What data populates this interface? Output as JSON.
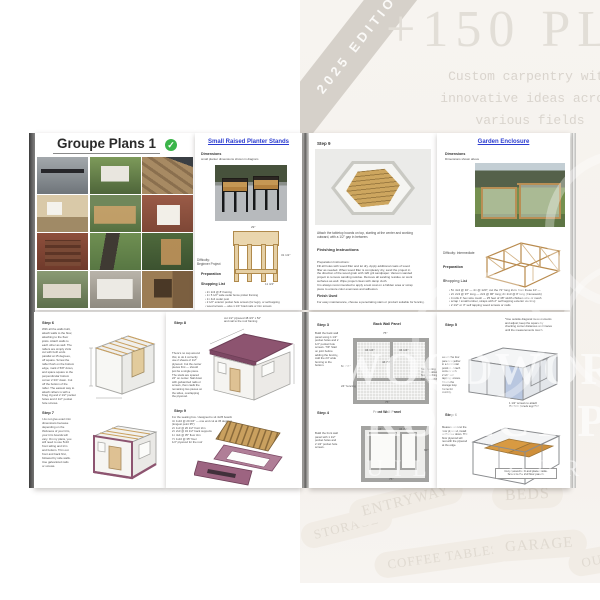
{
  "background": {
    "edition_ribbon": "2025 EDITION",
    "headline": "+150 PLANS",
    "tagline": [
      "Custom carpentry with",
      "innovative ideas across",
      "various fields"
    ],
    "watermark_line1": "WOODWORK",
    "watermark_line2": "PROJECT PLANS",
    "watermark_line3": "BUILD YOUR KINGDOM",
    "pills": [
      {
        "label": "STORAGE",
        "kind": "pill-storage"
      },
      {
        "label": "ENTRYWAY",
        "kind": "pill-entryway"
      },
      {
        "label": "BEDS",
        "kind": "pill-beds"
      },
      {
        "label": "COFFEE TABLES",
        "kind": "pill-coffee"
      },
      {
        "label": "GARAGE",
        "kind": "pill-garage"
      },
      {
        "label": "OUTDOOR",
        "kind": "pill-outdoor"
      }
    ],
    "colors": {
      "backdrop": "#f6f3ee",
      "ribbon": "#d6d1ca",
      "faint_text": "#ddd8d1"
    }
  },
  "colors": {
    "title_blue": "#2a3bd0",
    "check_green": "#3bb54a",
    "plum": "#8d5470",
    "floor_orange": "#d89a42"
  },
  "cover": {
    "title": "Groupe Plans 1",
    "check_icon": "✓",
    "photos": [
      {
        "kind": "ph-console"
      },
      {
        "kind": "ph-coop"
      },
      {
        "kind": "ph-deck"
      },
      {
        "kind": "ph-playhouse"
      },
      {
        "kind": "ph-enclosure"
      },
      {
        "kind": "ph-chair"
      },
      {
        "kind": "ph-firewood"
      },
      {
        "kind": "ph-aframe"
      },
      {
        "kind": "ph-ladder"
      },
      {
        "kind": "ph-bench"
      },
      {
        "kind": "ph-catio"
      },
      {
        "kind": "ph-cabinet"
      }
    ]
  },
  "planter": {
    "title": "Small Raised Planter Stands",
    "dimensions_label": "Dimensions",
    "dimensions_note": "small planter dimensions shown in diagram",
    "difficulty": "Difficulty: Beginner Project",
    "preparation_label": "Preparation",
    "shopping_label": "Shopping List",
    "shopping_list": [
      "2× 2x3 @ 8' framing",
      "1× 5 1/2\" wide cedar fence picket framing",
      "1× 4x4 cedar post",
      "2 1/2\" exterior pocket hole screws (for legs), or self-tapping",
      "wood screws — also 1 1/4\" brad nails or trim screws"
    ],
    "sketch_dims": {
      "top": "29\"",
      "right": "31 1/2\"",
      "bottom": "11 3/4\""
    }
  },
  "hexagon": {
    "step_label": "Step 9",
    "caption": [
      "Attach the tabletop boards on top, starting at the center and working",
      "outward, with a 1/2\" gap in between."
    ],
    "finishing_label": "Finishing Instructions",
    "prep_lines": [
      "Preparation Instructions:",
      "Fill all holes with wood filler and let dry. Apply additional coats of wood",
      "filler as needed. When wood filler is completely dry, sand the project in",
      "the direction of the wood grain with 120 grit sandpaper. Vacuum sanded",
      "project to remove sanding residue. Remove all sanding residue on work",
      "surfaces as well. Wipe project clean with damp cloth.",
      "It is always recommended to apply a test coat on a hidden area or scrap",
      "piece to ensure color evenness and adhesion."
    ],
    "finish_label": "Finish Used",
    "finish_line": "For easy maintenance, choose a penetrating stain or product suitable for fencing."
  },
  "garden": {
    "title": "Garden Enclosure",
    "dimensions_label": "Dimensions",
    "dimensions_note": "Dimensions shown above",
    "difficulty": "Difficulty: Intermediate",
    "preparation_label": "Preparation",
    "shopping_label": "Shopping List",
    "shopping_list": [
      "5× 4x4 @ 10' — 4× @ 120\"; cut the 72\" long 2x4s from these 10' —",
      "2× 2x3 @ 97\" long — 2x3 @ 96\" long; 2× 2x3 @ 8' long (framework)",
      "4 rolls 4' hex wire mesh — 25 feet of 48\" width chicken wire or mesh",
      "scrap / small lumber, straps with 2\" self tapping exterior decking",
      "2 1/2\" or 3\" self tapping wood screws or nails"
    ]
  },
  "shed67": {
    "step6_label": "Step 6",
    "step6_lines": [
      "With all the walls built,",
      "attach walls to the floor,",
      "attaching to the floor",
      "joists. Attach walls to",
      "each other as well. The",
      "rafters are simply 2x4s",
      "cut with both ends",
      "parallel at 15 degrees,",
      "off square. Screw the",
      "rafter flush on the bottom",
      "edge, mark 2 5/8\" down,",
      "and space square to the",
      "perpendicular bottom",
      "corner 2 3/4\" down. Cut",
      "off the bottom of the",
      "rafter. The easiest way to",
      "attach rafters is with a",
      "Kreg Jig and 2 1/2\" pocket",
      "holes and 2 1/2\" pocket",
      "hole screws."
    ],
    "step7_label": "Step 7",
    "step7_lines": [
      "I do not give exact trim",
      "dimensions because",
      "depending on the",
      "thickness of your trim,",
      "your trim boards will",
      "vary. On my plans, you",
      "will need to use 5x10",
      "front siding and trim",
      "and bottom. Trim out",
      "front and back first,",
      "followed by side walls.",
      "Use galvanized nails",
      "or screws."
    ]
  },
  "shed89": {
    "step8_label": "Step 8",
    "roof_note": [
      "cut 1/2\" plywood 48 3/4\" x 52\"",
      "and nail to the roof framing"
    ],
    "step8_lines": [
      "There's no cap around",
      "this; to do it correctly",
      "use 2 sheets of 1/2\"",
      "plywood. Cut the center",
      "pieces first — should",
      "just be a single piece.",
      "The studs are spaced",
      "24\" on center. Nail down",
      "with galvanized nails or",
      "screws, then caulk the",
      "remaining two pieces on",
      "the sides, overlapping",
      "the plywood."
    ],
    "step9_label": "Step 9",
    "cutlist": [
      "For the seating box / designed to sit 4x35 boards:",
      "4× 1x10 @ 29 3/4\" — one end cut at 45 degrees off square",
      "(longest point 35\")",
      "2× 1x3 @ 26 1/2\" front trim",
      "2× 2x3 @ 34 1/2\" back supports",
      "1× 4x4 @ 35\" floor trim",
      "7× 1x10 @ 35\" floor",
      "1/2\" plywood for the roof"
    ]
  },
  "panels": {
    "step3_label": "Step 3",
    "step3_lines": [
      "Build the back wall",
      "panel using 1 1/2\"",
      "pocket holes and 2",
      "1/2\" pocket hole",
      "screws. TIP: Start",
      "on joint before",
      "adding the fencing.",
      "Add the 24\" wide",
      "fencing to the",
      "bottom."
    ],
    "back_title": "Back Wall Panel",
    "back_dims": {
      "top": "75\"",
      "left": "62 7/8\"",
      "inner_left": "34 1/4\"",
      "inner_right": "34 1/4\"",
      "center": "44 7/8\"",
      "fencing": "24\" fencing",
      "bottom": "75\""
    },
    "side_note": [
      "Start fencing",
      "3in 1\" to allow",
      "floor attaching.",
      "For max width."
    ],
    "step4_label": "Step 4",
    "step4_lines": [
      "Build the front wall",
      "panel with 1 1/2\"",
      "pocket holes and",
      "2 1/2\" pocket hole",
      "screws."
    ],
    "front_title": "Front Wall Panel",
    "front_dims": {
      "left": "34 1/4\"",
      "right": "34 7/8\"",
      "height": "60\"",
      "bottom": "75\""
    }
  },
  "cage": {
    "step5_label": "Step 5",
    "note_top": [
      "*Use outside diagonal measurements",
      "and adjust; keep the square by",
      "checking corner distances and braces",
      "until the measurements match."
    ],
    "left5_lines": [
      "Attach the four",
      "panels together",
      "in a horizontal",
      "position. Attach",
      "corners with",
      "2 1/2\" self",
      "tapping screws.",
      "Attach the",
      "storage loop",
      "frame for",
      "stability."
    ],
    "screw_note": [
      "1 1/2\" screws to attach",
      "the face panels together"
    ],
    "step6_label": "Step 6",
    "left6_lines": [
      "Measure and cut the",
      "floor plywood, install",
      "and screw down. The",
      "floor plywood will",
      "rest with the plywood",
      "at the edge."
    ],
    "floor_caption": [
      "Cut plywood to fit and place inside.",
      "Screw to the 2x3 floor panels."
    ]
  }
}
